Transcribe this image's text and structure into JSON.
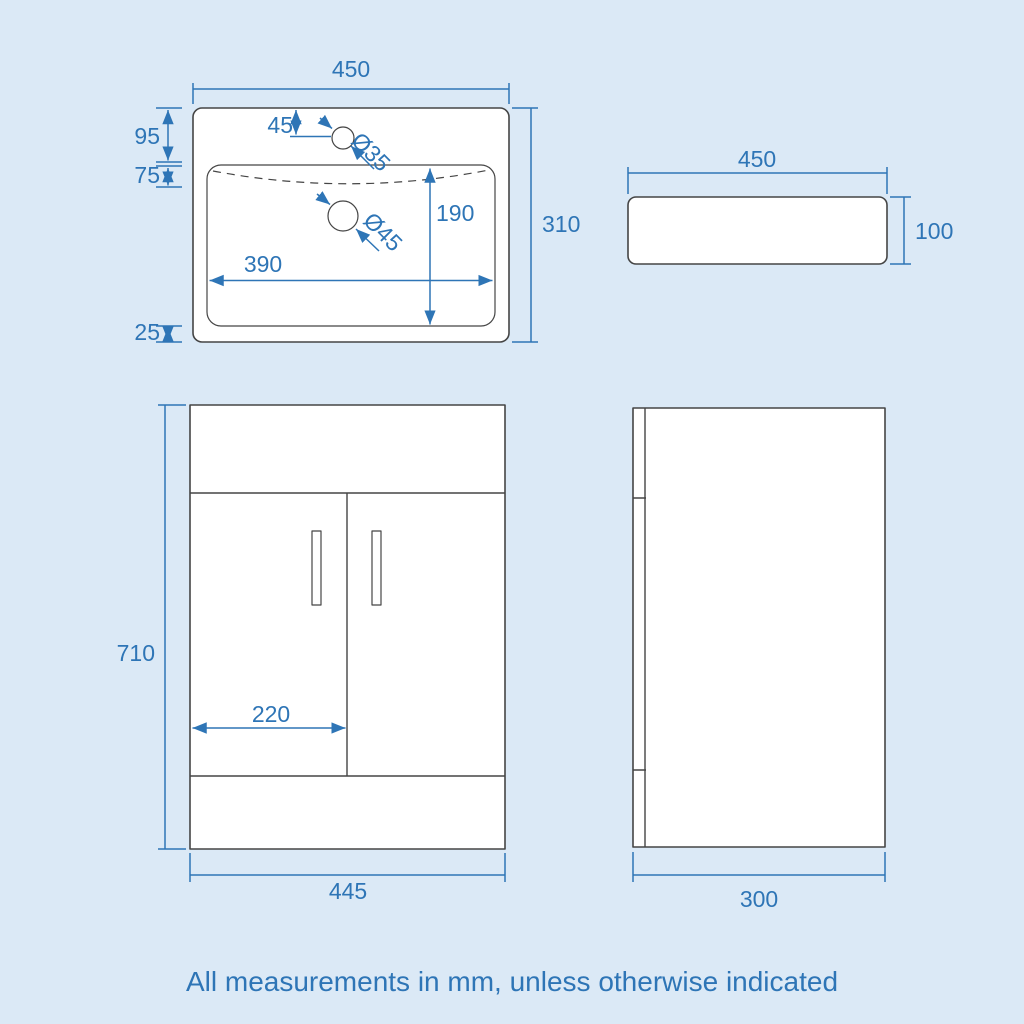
{
  "colors": {
    "background": "#dbe9f6",
    "dimension_blue": "#2e75b6",
    "drawing_gray": "#454545",
    "shape_fill": "#ffffff"
  },
  "footer": {
    "note": "All measurements in mm, unless otherwise indicated"
  },
  "basin_top": {
    "width": "450",
    "depth": "310",
    "rear_ledge": "95",
    "overflow_gap": "75",
    "front_ledge": "25",
    "tap_hole_offset": "45",
    "tap_hole_diameter": "Ø35",
    "waste_hole_diameter": "Ø45",
    "bowl_depth": "190",
    "bowl_width": "390"
  },
  "basin_side": {
    "width": "450",
    "height": "100"
  },
  "vanity_front": {
    "height": "710",
    "door_width": "220",
    "width": "445"
  },
  "vanity_side": {
    "depth": "300"
  }
}
